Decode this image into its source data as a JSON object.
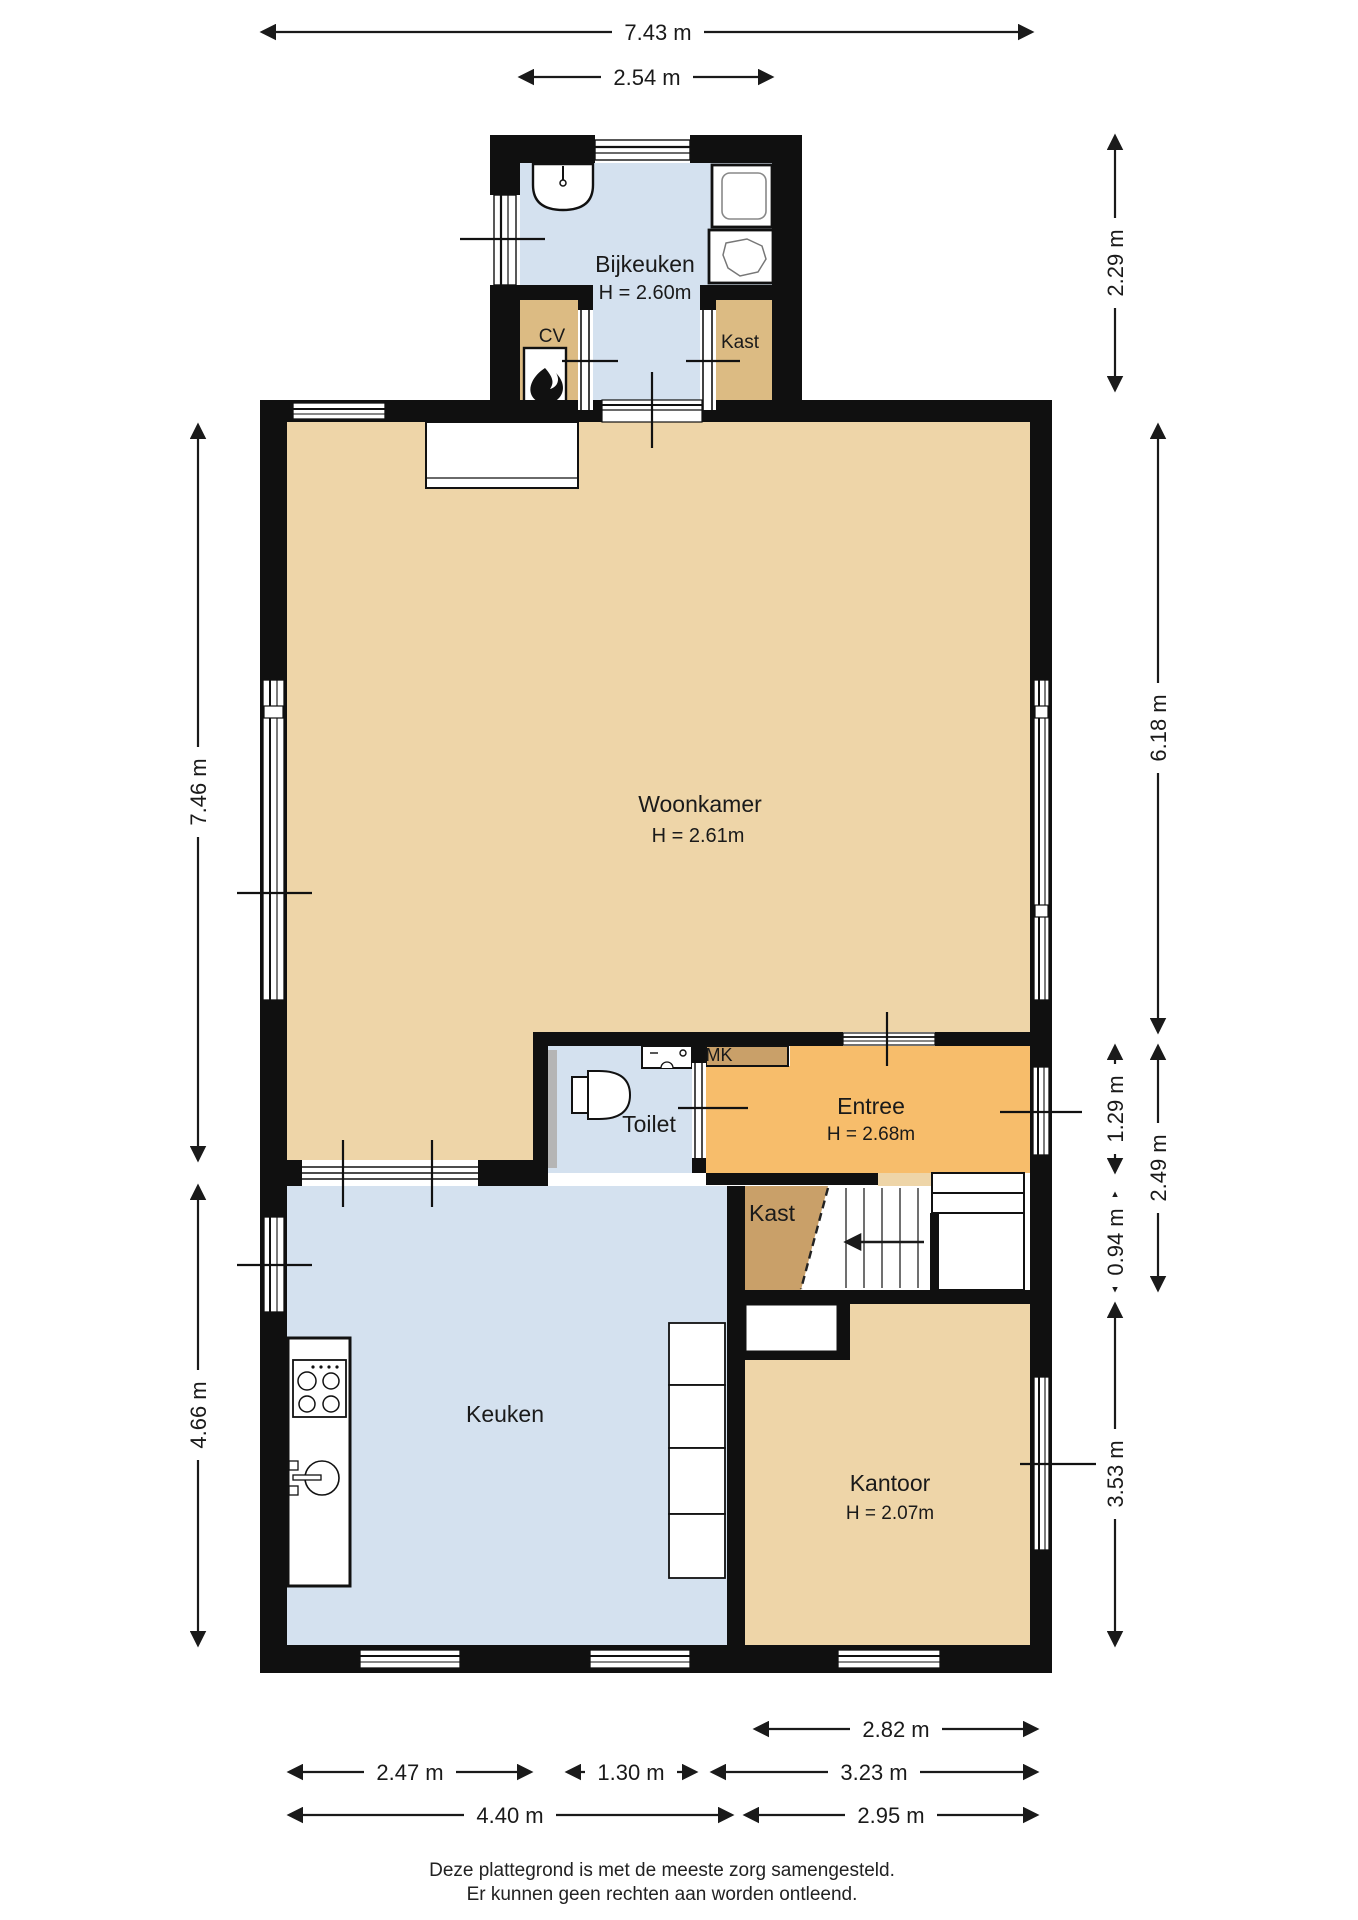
{
  "rooms": {
    "bijkeuken": {
      "label": "Bijkeuken",
      "height": "H = 2.60m"
    },
    "cv": {
      "label": "CV"
    },
    "kast_boven": {
      "label": "Kast"
    },
    "woonkamer": {
      "label": "Woonkamer",
      "height": "H = 2.61m"
    },
    "toilet": {
      "label": "Toilet"
    },
    "mk": {
      "label": "MK"
    },
    "entree": {
      "label": "Entree",
      "height": "H = 2.68m"
    },
    "kast_hal": {
      "label": "Kast"
    },
    "keuken": {
      "label": "Keuken"
    },
    "kantoor": {
      "label": "Kantoor",
      "height": "H = 2.07m"
    }
  },
  "dimensions": {
    "top_total": "7.43 m",
    "top_bijkeuken": "2.54 m",
    "right_bijkeuken": "2.29 m",
    "right_woonkamer": "6.18 m",
    "right_entree": "1.29 m",
    "right_hal": "2.49 m",
    "right_trap": "0.94 m",
    "right_kantoor": "3.53 m",
    "left_woonkamer": "7.46 m",
    "left_keuken": "4.66 m",
    "bottom_kantoor_raam": "2.82 m",
    "bottom_keuken_links": "2.47 m",
    "bottom_midden": "1.30 m",
    "bottom_rechts": "3.23 m",
    "bottom_keuken_totaal": "4.40 m",
    "bottom_kantoor_totaal": "2.95 m"
  },
  "footer": {
    "line1": "Deze plattegrond is met de meeste zorg samengesteld.",
    "line2": "Er kunnen geen rechten aan worden ontleend."
  },
  "colors": {
    "wall": "#101010",
    "tan": "#eed5a8",
    "blue": "#d4e1ef",
    "orange": "#f7bd6b",
    "brown": "#c9a069",
    "closet": "#dcbb83",
    "line": "#1a1a1a"
  }
}
